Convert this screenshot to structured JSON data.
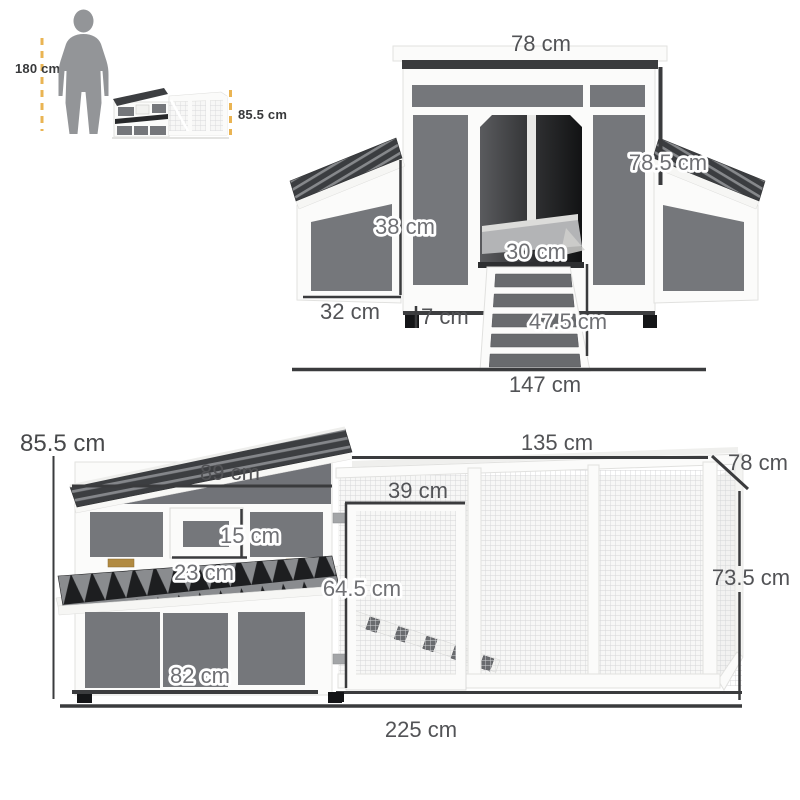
{
  "colors": {
    "accent_dash": "#eab453",
    "panel_gray": "#75777b",
    "shingle_dark": "#3b3d40",
    "label_gray": "#525356"
  },
  "scale_reference": {
    "person_height": "180 cm",
    "product_height": "85.5 cm"
  },
  "front_view": {
    "labels": {
      "roof_width": "78 cm",
      "side_height": "78.5 cm",
      "nest_box_height": "38 cm",
      "door_width": "30 cm",
      "nest_box_width": "32 cm",
      "leg_height": "7 cm",
      "ramp_length": "47.5 cm",
      "total_width": "147 cm"
    }
  },
  "side_view": {
    "labels": {
      "coop_height": "85.5 cm",
      "coop_length": "89 cm",
      "run_length": "135 cm",
      "run_depth": "78 cm",
      "run_door_width": "39 cm",
      "window_height": "15 cm",
      "window_width": "23 cm",
      "run_door_height": "64.5 cm",
      "run_height": "73.5 cm",
      "main_panel_width": "82 cm",
      "total_length": "225 cm"
    }
  }
}
